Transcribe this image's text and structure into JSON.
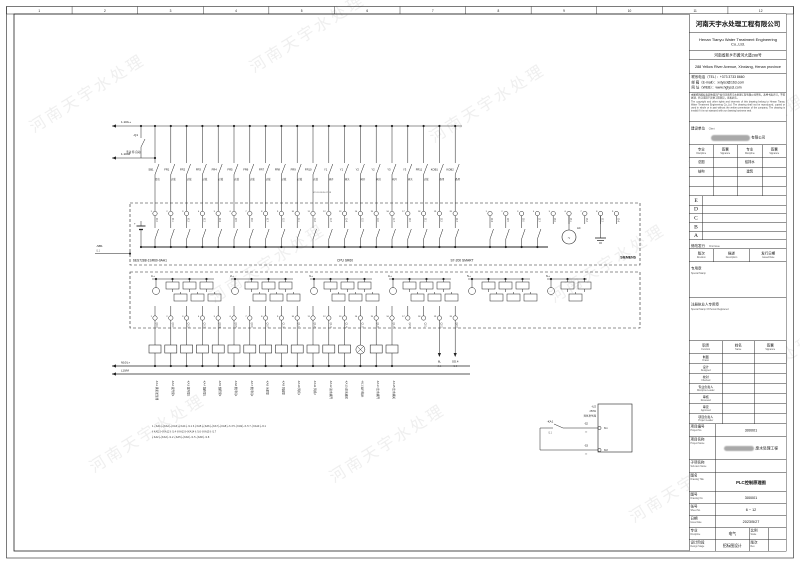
{
  "frame": {
    "columns": [
      "1",
      "2",
      "3",
      "4",
      "5",
      "6",
      "7",
      "8",
      "9",
      "10",
      "11",
      "12"
    ]
  },
  "watermark": "河南天宇水处理",
  "title_block": {
    "company_cn": "河南天宇水处理工程有限公司",
    "company_en": "Henan Tianyu Water Treatment Engineering Co.,Ltd.",
    "address_cn": "河南省新乡市黄河大道288号",
    "address_en": "288 Yellow River Avenue, Xinxiang, Henan province",
    "tel": "联系电话（TEL）：+373 3733 8660",
    "email": "邮  箱（E-mail）：xxtyscl@163.com",
    "web": "网  址（WEB）：www.hgtyscl.com",
    "disclaimer_cn": "本图纸的版权及其他知识产权归河南天宇水处理工程有限公司所有，未经书面许可，不得复制、转让或用于其他工程项目，违者必究。",
    "disclaimer_en": "The copyright and other rights and interests of this drawing belong to Henan Tianyu Water Treatment Engineering Co.,Ltd. The drawing shall not be reproduced, copied or used in whole or in part without the written permission of the company. The drawing is invalid if it is not stamped with our drawing business seal.",
    "client_label_cn": "建设单位",
    "client_label_en": "Client",
    "client_suffix": "有限公司",
    "sig_table": {
      "header": [
        {
          "cn": "专业",
          "en": "Discipline"
        },
        {
          "cn": "签署",
          "en": "Signature"
        },
        {
          "cn": "专业",
          "en": "Discipline"
        },
        {
          "cn": "签署",
          "en": "Signature"
        }
      ],
      "rows": [
        [
          "总图",
          "",
          "给排水",
          ""
        ],
        [
          "结构",
          "",
          "建筑",
          ""
        ],
        [
          "",
          "",
          "",
          ""
        ],
        [
          "",
          "",
          "",
          ""
        ]
      ]
    },
    "revisions": [
      "E",
      "D",
      "C",
      "B",
      "A"
    ],
    "first_issue_cn": "修改发行",
    "first_issue_en": "First Issue",
    "rev_cols": [
      {
        "cn": "版次",
        "en": "Revision"
      },
      {
        "cn": "描述",
        "en": "Description"
      },
      {
        "cn": "发行日期",
        "en": "Issued Date"
      }
    ],
    "stamp_cn": "专用章",
    "stamp_en": "Special Stamp",
    "reg_stamp_cn": "注册执业人专用章",
    "reg_stamp_en": "Special Stamp Of Person Registered",
    "func_header": [
      {
        "cn": "职责",
        "en": "Function"
      },
      {
        "cn": "姓名",
        "en": "Name"
      },
      {
        "cn": "签署",
        "en": "Signature"
      }
    ],
    "func_rows": [
      {
        "cn": "制图",
        "en": "Drawn"
      },
      {
        "cn": "设计",
        "en": "Designed"
      },
      {
        "cn": "校对",
        "en": "Checked"
      },
      {
        "cn": "专业负责人",
        "en": "Discipline Leader"
      },
      {
        "cn": "审核",
        "en": "Reviewed"
      },
      {
        "cn": "审定",
        "en": "Approved"
      },
      {
        "cn": "项目负责人",
        "en": "Project Leader"
      }
    ],
    "project_no_label_cn": "项目编号",
    "project_no_label_en": "Project No.",
    "project_no": "300001",
    "project_name_label_cn": "项目名称",
    "project_name_label_en": "Project Name",
    "project_name_suffix": "废水处理工程",
    "subitem_label_cn": "子项名称",
    "subitem_label_en": "Sub-item Name",
    "subitem": "",
    "drawing_title_label_cn": "图名",
    "drawing_title_label_en": "Drawing Title",
    "drawing_title": "PLC控制原理图",
    "drawing_no_label_cn": "图号",
    "drawing_no_label_en": "Drawing No.",
    "drawing_no": "300001",
    "sheet_label_cn": "张号",
    "sheet_label_en": "Sheet No.",
    "sheet": "6 ~ 12",
    "date_label_cn": "日期",
    "date_label_en": "Issue Date",
    "date": "2023/5/27",
    "discipline_label_cn": "专业",
    "discipline_label_en": "Discipline",
    "discipline": "电气",
    "scale_label_cn": "比例",
    "scale_label_en": "Scale",
    "scale": "",
    "stage_label_cn": "设计阶段",
    "stage_label_en": "Design Stage",
    "stage": "招标图设计",
    "rev_label_cn": "版次",
    "rev_label_en": "Rev.",
    "rev": ""
  },
  "schematic": {
    "bus1_label": "1.10/L+",
    "bus2_label": "1.10/M",
    "q1_tag": "-Q1",
    "q1_positions": "手动 停 自动",
    "sb1_tag": "-SB1",
    "sb1_ref": "/1.1",
    "xref_row": "X2  01  03  05  07  09",
    "contacts": [
      {
        "tag": "SB1",
        "sub": "复位"
      },
      {
        "tag": "FR1",
        "sub": "过载"
      },
      {
        "tag": "FR2",
        "sub": "过载"
      },
      {
        "tag": "FR3",
        "sub": "过载"
      },
      {
        "tag": "FR4",
        "sub": "过载"
      },
      {
        "tag": "FR5",
        "sub": "过载"
      },
      {
        "tag": "FR6",
        "sub": "过载"
      },
      {
        "tag": "FR7",
        "sub": "过载"
      },
      {
        "tag": "FR8",
        "sub": "过载"
      },
      {
        "tag": "FR9",
        "sub": "过载"
      },
      {
        "tag": "FR10",
        "sub": "过载"
      },
      {
        "tag": "Y1",
        "sub": "阀开"
      },
      {
        "tag": "Y1",
        "sub": "阀关"
      },
      {
        "tag": "Y2",
        "sub": "阀开"
      },
      {
        "tag": "Y2",
        "sub": "阀关"
      },
      {
        "tag": "Y3",
        "sub": "阀开"
      },
      {
        "tag": "Y3",
        "sub": "阀关"
      },
      {
        "tag": "FR11",
        "sub": "过载"
      },
      {
        "tag": "KOB1",
        "sub": "备用"
      },
      {
        "tag": "KOB2",
        "sub": "备用"
      }
    ],
    "di_addresses": [
      "I0.0",
      "I0.1",
      "I0.2",
      "I0.3",
      "I0.4",
      "I0.5",
      "I0.6",
      "I0.7",
      "I1.0",
      "I1.1",
      "I1.2",
      "I1.3",
      "I1.4",
      "I1.5",
      "I1.6",
      "I1.7",
      "I2.0",
      "I2.1",
      "I2.2",
      "I2.3"
    ],
    "di2_addresses": [
      "I2.4",
      "I2.5",
      "I2.6",
      "I2.7",
      "I3.0",
      "I3.1",
      "I3.2",
      "I3.3",
      "I3.4"
    ],
    "do_addresses": [
      "Q0.0",
      "Q0.1",
      "Q0.2",
      "Q0.3",
      "Q0.4",
      "Q0.5",
      "Q0.6",
      "Q0.7",
      "Q1.0",
      "Q1.1",
      "Q1.2",
      "Q1.3",
      "Q1.4",
      "Q1.5",
      "Q1.6",
      "Q1.7",
      "Q2.0",
      "Q2.1",
      "Q2.2",
      "Q2.3"
    ],
    "plc_model": "6ES7288-1SR60-0AA1",
    "plc_cpu": "CPU SR60",
    "plc_series": "S7-200 SMART",
    "plc_brand": "SIEMENS",
    "ac_label": "AC",
    "do_group_labels": [
      "1L+",
      "2L+",
      "3L+",
      "4L+",
      "5L+",
      "6L+"
    ],
    "bus3_label": "N10/L+",
    "bus4_label": "L10/M",
    "coils": [
      {
        "tag": "-KA1",
        "desc": "臭氧发生器",
        "type": "relay"
      },
      {
        "tag": "-KA2",
        "desc": "提升泵1",
        "type": "relay"
      },
      {
        "tag": "-KA3",
        "desc": "提升泵2",
        "type": "relay"
      },
      {
        "tag": "-KA4",
        "desc": "加药泵1",
        "type": "relay"
      },
      {
        "tag": "-KA5",
        "desc": "加药泵2",
        "type": "relay"
      },
      {
        "tag": "-KA6",
        "desc": "搅拌机1",
        "type": "relay"
      },
      {
        "tag": "-KA7",
        "desc": "搅拌机2",
        "type": "relay"
      },
      {
        "tag": "-KA8",
        "desc": "污泥泵",
        "type": "relay"
      },
      {
        "tag": "-KA9",
        "desc": "回流泵",
        "type": "relay"
      },
      {
        "tag": "-KA10",
        "desc": "风机1",
        "type": "relay"
      },
      {
        "tag": "-KA11",
        "desc": "风机2",
        "type": "relay"
      },
      {
        "tag": "-KA12",
        "desc": "进水阀开",
        "type": "relay"
      },
      {
        "tag": "-KA13",
        "desc": "进水阀关",
        "type": "relay"
      },
      {
        "tag": "-HL1",
        "desc": "运行指示",
        "type": "lamp"
      },
      {
        "tag": "-KA14",
        "desc": "出水阀开",
        "type": "relay"
      },
      {
        "tag": "-KA15",
        "desc": "出水阀关",
        "type": "relay"
      }
    ],
    "arrow1": "6L",
    "arrow1_ref": "/1.1",
    "arrow2": "GD.4",
    "arrow2_ref": "/1.8",
    "notes": [
      "1 ┤KA1├┤KA2├┤KA3├┤KA4├ /1.1   3 ┤KA5├┤KA6├┤KA7├┤KA8├ /1.3   5 ┤KA9├ /1.5   7 ┤KA10├ /2.1",
      "  ┤KA11├┤KA12├ /1.4          ┤KA13├┤KA14├ /1.6        ┤KA15├ /1.7",
      "  ┤KA2├┤KA3├ /1.2            ┤KA5├┤KA6├ /1.5          ┤KA8├ /1.8"
    ],
    "subcircuit": {
      "ka_tag": "-KA1",
      "ka_ref": "/1.1",
      "u_tag": "-U2",
      "power": "250W",
      "device": "臭氧发生器",
      "s2": "-S2",
      "s2_t": "12",
      "s3": "-S3",
      "s3_t": "12",
      "term1": "611",
      "term2": "618"
    }
  }
}
